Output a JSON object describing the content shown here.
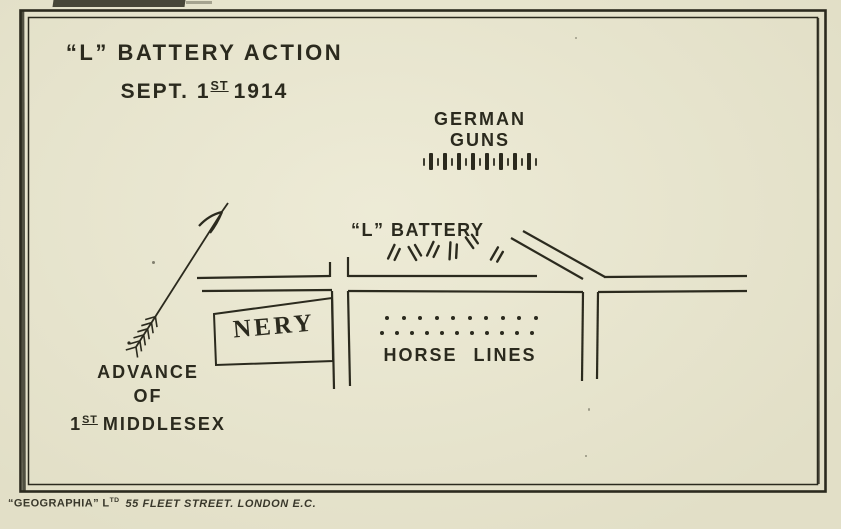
{
  "title": {
    "line1": "“L” BATTERY ACTION",
    "line2_prefix": "SEPT. 1",
    "line2_sup": "ST",
    "line2_suffix": "1914"
  },
  "labels": {
    "german_guns_line1": "GERMAN",
    "german_guns_line2": "GUNS",
    "l_battery": "“L” BATTERY",
    "nery": "NERY",
    "horse_lines": "HORSE LINES",
    "advance_line1": "ADVANCE",
    "advance_line2": "OF",
    "advance_line3_prefix": "1",
    "advance_line3_sup": "ST",
    "advance_line3_suffix": "MIDDLESEX"
  },
  "caption": {
    "name": "“GEOGRAPHIA” L",
    "sup": "TD",
    "address": "55 FLEET STREET. LONDON E.C."
  },
  "symbols": {
    "german_gun_count": 8,
    "battery_guns": [
      {
        "x": 394,
        "y": 253,
        "a": 25,
        "l": 15
      },
      {
        "x": 415,
        "y": 252,
        "a": -30,
        "l": 15
      },
      {
        "x": 433,
        "y": 250,
        "a": 25,
        "l": 15
      },
      {
        "x": 453,
        "y": 251,
        "a": 3,
        "l": 17
      },
      {
        "x": 472,
        "y": 241,
        "a": -35,
        "l": 13
      },
      {
        "x": 497,
        "y": 255,
        "a": 30,
        "l": 14
      }
    ],
    "horse_dot_rows": [
      {
        "x": 385,
        "y": 316,
        "count": 10,
        "gap": 12.5
      },
      {
        "x": 380,
        "y": 331,
        "count": 11,
        "gap": 11
      }
    ]
  },
  "colors": {
    "ink": "#2b2a1e",
    "paper": "#e9e6cd"
  }
}
